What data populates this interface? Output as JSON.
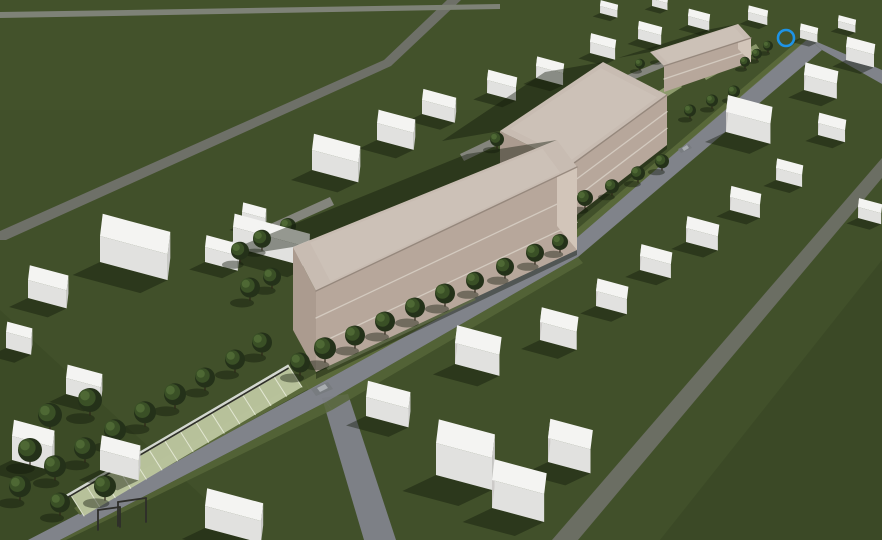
{
  "meta": {
    "title": "Aerial 3D site massing rendering - two-row masterplan with three tan halls",
    "width": 882,
    "height": 540
  },
  "palette": {
    "grass": "#41502a",
    "grass_zone_top": "#4a582e",
    "grass_zone_right": "#2f3d1d",
    "grass_zone_bl": "#313f1e",
    "road_main": "#80838a",
    "road_secondary": "#6b6e63",
    "road_minor": "#6e7068",
    "road_band": "#7e8277",
    "lane": "#84857d",
    "verge": "#5d6c3c",
    "verge2": "#566538",
    "pale_path": "#9aa878",
    "parking_base": "#bec7a0",
    "parking_line": "#edf0e0",
    "wall_light": "#d3d7d1",
    "wall_dark": "#2f2f2b",
    "white_top": "#f4f4f2",
    "white_front": "#e1e1df",
    "white_right": "#c9c9c7",
    "white_left": "#cccac8",
    "tan_roof": "#c8bcb2",
    "tan_roof_inner": "#d0c5bb",
    "tan_facade": "#b7a79b",
    "tan_band": "#d7cec4",
    "tan_end_light": "#d2c5b9",
    "tan_end_dark": "#ab9b8f",
    "tan_parapet": "#93857a",
    "shadow": "rgba(16,25,9,0.42)",
    "tree_dark": "#243119",
    "tree_mid": "#3a5026",
    "tree_light": "#4e6834",
    "trunk": "#2c2418",
    "car_body": "#787c80",
    "car_roof": "#a9adb1",
    "marker_blue": "#1e93e6"
  },
  "ground": {
    "zones": [
      {
        "kind": "rect",
        "x": 0,
        "y": 0,
        "w": 882,
        "h": 110,
        "fill": "#4a582e",
        "opacity": 0.3
      },
      {
        "kind": "poly",
        "points": [
          [
            660,
            540
          ],
          [
            882,
            260
          ],
          [
            882,
            540
          ]
        ],
        "fill": "#2f3d1d",
        "opacity": 0.3
      },
      {
        "kind": "poly",
        "points": [
          [
            0,
            310
          ],
          [
            250,
            540
          ],
          [
            0,
            540
          ]
        ],
        "fill": "#313f1e",
        "opacity": 0.28
      }
    ]
  },
  "roads": [
    {
      "name": "main-street",
      "color": "#80838a",
      "points": [
        [
          28,
          540
        ],
        [
          80,
          513
        ],
        [
          308,
          390
        ],
        [
          566,
          247
        ],
        [
          808,
          38
        ],
        [
          822,
          50
        ],
        [
          578,
          257
        ],
        [
          326,
          402
        ],
        [
          60,
          540
        ]
      ]
    },
    {
      "name": "main-street-top-exit",
      "color": "#80838a",
      "points": [
        [
          808,
          38
        ],
        [
          822,
          50
        ],
        [
          882,
          84
        ],
        [
          882,
          70
        ]
      ]
    },
    {
      "name": "upper-left-road",
      "color": "#6e7068",
      "points": [
        [
          447,
          0
        ],
        [
          461,
          0
        ],
        [
          391,
          66
        ],
        [
          6,
          240
        ],
        [
          0,
          240
        ],
        [
          0,
          231
        ],
        [
          384,
          60
        ]
      ]
    },
    {
      "name": "horizon-road",
      "color": "#7e8277",
      "points": [
        [
          0,
          12
        ],
        [
          500,
          4
        ],
        [
          500,
          9
        ],
        [
          0,
          18
        ]
      ]
    },
    {
      "name": "right-road",
      "color": "#6b6e63",
      "points": [
        [
          882,
          158
        ],
        [
          882,
          178
        ],
        [
          578,
          540
        ],
        [
          552,
          540
        ]
      ]
    },
    {
      "name": "bottom-spur-road",
      "color": "#7d8086",
      "points": [
        [
          322,
          398
        ],
        [
          348,
          394
        ],
        [
          396,
          540
        ],
        [
          364,
          540
        ]
      ]
    },
    {
      "name": "service-lane-1",
      "color": "#84857d",
      "points": [
        [
          226,
          244
        ],
        [
          330,
          197
        ],
        [
          334,
          205
        ],
        [
          230,
          252
        ]
      ]
    },
    {
      "name": "service-lane-2",
      "color": "#84857d",
      "points": [
        [
          460,
          154
        ],
        [
          560,
          106
        ],
        [
          564,
          113
        ],
        [
          464,
          161
        ]
      ]
    },
    {
      "name": "service-lane-3",
      "color": "#84857d",
      "points": [
        [
          620,
          78
        ],
        [
          700,
          45
        ],
        [
          703,
          51
        ],
        [
          623,
          84
        ]
      ]
    }
  ],
  "strips": [
    {
      "name": "verge-nw-1",
      "fill": "#5d6c3c",
      "opacity": 0.9,
      "points": [
        [
          74,
          508
        ],
        [
          304,
          380
        ],
        [
          310,
          388
        ],
        [
          80,
          515
        ]
      ]
    },
    {
      "name": "verge-nw-2",
      "fill": "#5d6c3c",
      "opacity": 0.9,
      "points": [
        [
          304,
          380
        ],
        [
          562,
          242
        ],
        [
          566,
          248
        ],
        [
          308,
          390
        ]
      ]
    },
    {
      "name": "verge-nw-3",
      "fill": "#5d6c3c",
      "opacity": 0.85,
      "points": [
        [
          562,
          242
        ],
        [
          806,
          34
        ],
        [
          809,
          38
        ],
        [
          566,
          247
        ]
      ]
    },
    {
      "name": "verge-se-1",
      "fill": "#566538",
      "opacity": 0.85,
      "points": [
        [
          60,
          540
        ],
        [
          326,
          402
        ],
        [
          332,
          410
        ],
        [
          66,
          540
        ]
      ]
    },
    {
      "name": "verge-se-2",
      "fill": "#566538",
      "opacity": 0.85,
      "points": [
        [
          326,
          402
        ],
        [
          578,
          257
        ],
        [
          583,
          263
        ],
        [
          332,
          410
        ]
      ]
    },
    {
      "name": "pale-path-1",
      "fill": "#9aa878",
      "opacity": 0.85,
      "points": [
        [
          322,
          362
        ],
        [
          470,
          292
        ],
        [
          476,
          300
        ],
        [
          328,
          370
        ]
      ]
    },
    {
      "name": "pale-path-2",
      "fill": "#9aa878",
      "opacity": 0.85,
      "points": [
        [
          598,
          130
        ],
        [
          676,
          80
        ],
        [
          682,
          87
        ],
        [
          604,
          137
        ]
      ]
    },
    {
      "name": "pale-path-3",
      "fill": "#9aa878",
      "opacity": 0.8,
      "points": [
        [
          702,
          74
        ],
        [
          756,
          44
        ],
        [
          760,
          50
        ],
        [
          706,
          80
        ]
      ]
    }
  ],
  "parking": {
    "name": "paver-parking-strip",
    "inner": [
      [
        84,
        516
      ],
      [
        302,
        387
      ]
    ],
    "outer": [
      [
        70,
        494
      ],
      [
        288,
        365
      ]
    ],
    "stripes": 14,
    "base": "#bec7a0",
    "line": "#edf0e0"
  },
  "wall": {
    "a": [
      66,
      496
    ],
    "b": [
      288,
      366
    ],
    "light": "#d3d7d1",
    "dark": "#2f2f2b"
  },
  "goal_frames": [
    [
      [
        118,
        502
      ],
      [
        118,
        526
      ]
    ],
    [
      [
        146,
        498
      ],
      [
        146,
        522
      ]
    ],
    [
      [
        118,
        502
      ],
      [
        146,
        498
      ]
    ],
    [
      [
        98,
        510
      ],
      [
        98,
        530
      ]
    ],
    [
      [
        120,
        507
      ],
      [
        120,
        527
      ]
    ],
    [
      [
        98,
        510
      ],
      [
        120,
        507
      ]
    ]
  ],
  "white_buildings": [
    [
      100,
      262,
      70,
      30,
      26
    ],
    [
      28,
      298,
      40,
      20,
      18
    ],
    [
      205,
      262,
      34,
      16,
      15
    ],
    [
      242,
      224,
      24,
      13,
      12
    ],
    [
      312,
      170,
      48,
      22,
      20
    ],
    [
      377,
      140,
      38,
      18,
      17
    ],
    [
      422,
      114,
      34,
      15,
      14
    ],
    [
      487,
      93,
      30,
      14,
      13
    ],
    [
      536,
      78,
      28,
      13,
      12
    ],
    [
      590,
      53,
      26,
      12,
      11
    ],
    [
      638,
      39,
      24,
      11,
      10
    ],
    [
      688,
      25,
      22,
      10,
      9
    ],
    [
      233,
      247,
      78,
      18,
      20
    ],
    [
      600,
      13,
      18,
      8,
      7
    ],
    [
      652,
      6,
      16,
      7,
      7
    ],
    [
      748,
      20,
      20,
      9,
      8
    ],
    [
      800,
      38,
      18,
      9,
      8
    ],
    [
      6,
      348,
      26,
      14,
      16
    ],
    [
      12,
      460,
      42,
      22,
      24
    ],
    [
      66,
      394,
      36,
      18,
      16
    ],
    [
      100,
      470,
      40,
      20,
      20
    ],
    [
      205,
      528,
      58,
      24,
      22
    ],
    [
      455,
      364,
      46,
      24,
      21
    ],
    [
      540,
      340,
      38,
      20,
      18
    ],
    [
      596,
      306,
      32,
      17,
      15
    ],
    [
      366,
      416,
      44,
      22,
      19
    ],
    [
      436,
      475,
      58,
      32,
      32
    ],
    [
      492,
      508,
      54,
      28,
      28
    ],
    [
      548,
      462,
      44,
      26,
      24
    ],
    [
      640,
      270,
      32,
      16,
      14
    ],
    [
      686,
      242,
      33,
      16,
      14
    ],
    [
      730,
      210,
      31,
      15,
      13
    ],
    [
      776,
      180,
      27,
      13,
      12
    ],
    [
      726,
      132,
      46,
      23,
      20
    ],
    [
      804,
      90,
      34,
      17,
      15
    ],
    [
      846,
      60,
      29,
      14,
      13
    ],
    [
      818,
      135,
      28,
      14,
      12
    ],
    [
      858,
      218,
      24,
      12,
      11
    ],
    [
      838,
      28,
      18,
      8,
      7
    ]
  ],
  "tan_buildings": [
    {
      "name": "tan-hall-1",
      "sortY": 250,
      "bands": 2,
      "shadow": [
        [
          293,
          247
        ],
        [
          557,
          140
        ],
        [
          467,
          154
        ],
        [
          203,
          261
        ]
      ],
      "roof": [
        [
          293,
          247
        ],
        [
          316,
          291
        ],
        [
          577,
          167
        ],
        [
          557,
          140
        ]
      ],
      "facade": [
        [
          316,
          291
        ],
        [
          577,
          167
        ],
        [
          577,
          250
        ],
        [
          316,
          372
        ]
      ],
      "end_light": [
        [
          557,
          140
        ],
        [
          577,
          167
        ],
        [
          577,
          250
        ],
        [
          557,
          226
        ]
      ],
      "end_dark": [
        [
          293,
          247
        ],
        [
          316,
          291
        ],
        [
          316,
          372
        ],
        [
          293,
          330
        ]
      ],
      "contact": [
        [
          316,
          370
        ],
        [
          577,
          248
        ],
        [
          577,
          255
        ],
        [
          316,
          379
        ]
      ]
    },
    {
      "name": "tan-hall-2",
      "sortY": 145,
      "bands": 2,
      "shadow": [
        [
          500,
          131
        ],
        [
          603,
          62
        ],
        [
          545,
          72
        ],
        [
          442,
          141
        ]
      ],
      "roof": [
        [
          500,
          131
        ],
        [
          570,
          166
        ],
        [
          667,
          95
        ],
        [
          603,
          62
        ]
      ],
      "facade": [
        [
          570,
          166
        ],
        [
          667,
          95
        ],
        [
          667,
          145
        ],
        [
          570,
          220
        ]
      ],
      "end_dark": [
        [
          500,
          131
        ],
        [
          570,
          166
        ],
        [
          570,
          220
        ],
        [
          500,
          178
        ]
      ],
      "contact": [
        [
          570,
          218
        ],
        [
          667,
          143
        ],
        [
          667,
          149
        ],
        [
          570,
          226
        ]
      ]
    },
    {
      "name": "tan-hall-3",
      "sortY": 64,
      "bands": 1,
      "shadow": [
        [
          650,
          52
        ],
        [
          738,
          24
        ],
        [
          706,
          30
        ],
        [
          618,
          58
        ]
      ],
      "roof": [
        [
          650,
          52
        ],
        [
          664,
          66
        ],
        [
          751,
          38
        ],
        [
          738,
          24
        ]
      ],
      "facade": [
        [
          664,
          66
        ],
        [
          751,
          38
        ],
        [
          751,
          62
        ],
        [
          664,
          92
        ]
      ],
      "end_light": [
        [
          738,
          24
        ],
        [
          751,
          38
        ],
        [
          751,
          62
        ],
        [
          738,
          49
        ]
      ]
    }
  ],
  "trees": [
    [
      325,
      362,
      11
    ],
    [
      355,
      348,
      10
    ],
    [
      385,
      334,
      10
    ],
    [
      415,
      320,
      10
    ],
    [
      445,
      306,
      10
    ],
    [
      475,
      292,
      9
    ],
    [
      505,
      278,
      9
    ],
    [
      535,
      264,
      9
    ],
    [
      560,
      252,
      8
    ],
    [
      585,
      208,
      8
    ],
    [
      612,
      195,
      7
    ],
    [
      638,
      182,
      7
    ],
    [
      662,
      170,
      7
    ],
    [
      690,
      118,
      6
    ],
    [
      712,
      108,
      6
    ],
    [
      734,
      99,
      6
    ],
    [
      262,
      250,
      9
    ],
    [
      288,
      236,
      8
    ],
    [
      240,
      262,
      9
    ],
    [
      497,
      148,
      7
    ],
    [
      522,
      136,
      7
    ],
    [
      547,
      124,
      7
    ],
    [
      640,
      70,
      5
    ],
    [
      660,
      61,
      5
    ],
    [
      55,
      480,
      11
    ],
    [
      85,
      462,
      11
    ],
    [
      115,
      444,
      11
    ],
    [
      145,
      426,
      11
    ],
    [
      175,
      408,
      11
    ],
    [
      205,
      390,
      10
    ],
    [
      235,
      372,
      10
    ],
    [
      262,
      355,
      10
    ],
    [
      50,
      430,
      12
    ],
    [
      90,
      415,
      12
    ],
    [
      30,
      465,
      12
    ],
    [
      20,
      500,
      11
    ],
    [
      105,
      500,
      11
    ],
    [
      60,
      515,
      10
    ],
    [
      250,
      300,
      10
    ],
    [
      272,
      288,
      9
    ],
    [
      757,
      60,
      5
    ],
    [
      768,
      52,
      5
    ],
    [
      745,
      68,
      5
    ],
    [
      545,
      240,
      7
    ],
    [
      300,
      375,
      10
    ]
  ],
  "cars": [
    {
      "name": "car-on-lower-street",
      "body": [
        [
          311,
          389
        ],
        [
          328,
          382
        ],
        [
          333,
          389
        ],
        [
          316,
          396
        ]
      ],
      "roof": [
        [
          317,
          388
        ],
        [
          325,
          384
        ],
        [
          328,
          388
        ],
        [
          320,
          392
        ]
      ]
    },
    {
      "name": "car-on-upper-street",
      "body": [
        [
          678,
          149
        ],
        [
          689,
          144
        ],
        [
          692,
          148
        ],
        [
          681,
          153
        ]
      ],
      "roof": [
        [
          682,
          148
        ],
        [
          687,
          145
        ],
        [
          689,
          148
        ],
        [
          684,
          151
        ]
      ]
    }
  ],
  "marker": {
    "name": "selection-ring",
    "x": 786,
    "y": 38,
    "r": 8,
    "color": "#1e93e6",
    "stroke_width": 2.6
  }
}
